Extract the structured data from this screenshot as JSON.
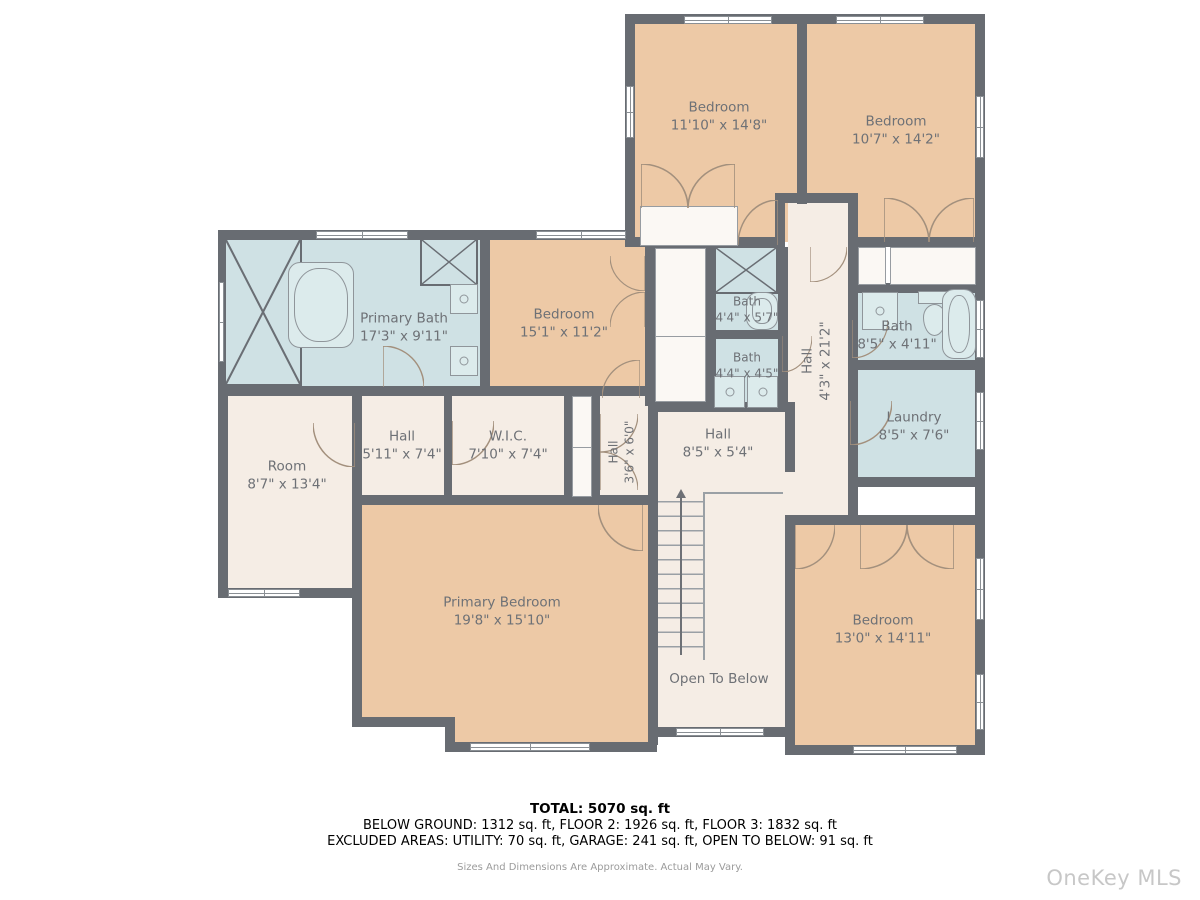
{
  "plan": {
    "rooms": {
      "bedroom_top_left": {
        "name": "Bedroom",
        "dims": "11'10\" x 14'8\""
      },
      "bedroom_top_right": {
        "name": "Bedroom",
        "dims": "10'7\" x 14'2\""
      },
      "primary_bath": {
        "name": "Primary Bath",
        "dims": "17'3\" x 9'11\""
      },
      "bedroom_middle": {
        "name": "Bedroom",
        "dims": "15'1\" x 11'2\""
      },
      "bath_upper": {
        "name": "Bath",
        "dims": "4'4\" x 5'7\""
      },
      "bath_lower": {
        "name": "Bath",
        "dims": "4'4\" x 4'5\""
      },
      "hall_vertical": {
        "name": "Hall",
        "dims": "4'3\" x 21'2\""
      },
      "bath_right": {
        "name": "Bath",
        "dims": "8'5\" x 4'11\""
      },
      "laundry": {
        "name": "Laundry",
        "dims": "8'5\" x 7'6\""
      },
      "room_left": {
        "name": "Room",
        "dims": "8'7\" x 13'4\""
      },
      "hall_small": {
        "name": "Hall",
        "dims": "5'11\" x 7'4\""
      },
      "wic": {
        "name": "W.I.C.",
        "dims": "7'10\" x 7'4\""
      },
      "hall_tiny": {
        "name": "Hall",
        "dims": "3'6\" x 6'0\""
      },
      "hall_center": {
        "name": "Hall",
        "dims": "8'5\" x 5'4\""
      },
      "primary_bedroom": {
        "name": "Primary Bedroom",
        "dims": "19'8\" x 15'10\""
      },
      "bedroom_bottom": {
        "name": "Bedroom",
        "dims": "13'0\" x 14'11\""
      },
      "open_to_below": {
        "name": "Open To Below"
      }
    },
    "colors": {
      "wall": "#686c72",
      "bedroom_fill": "#edc9a6",
      "bath_fill": "#cfe1e4",
      "hall_fill": "#f5ede5"
    }
  },
  "footer": {
    "total": "TOTAL: 5070 sq. ft",
    "areas": "BELOW GROUND: 1312 sq. ft, FLOOR 2: 1926 sq. ft, FLOOR 3: 1832 sq. ft",
    "excluded": "EXCLUDED AREAS: UTILITY: 70 sq. ft, GARAGE: 241 sq. ft, OPEN TO BELOW: 91 sq. ft",
    "disclaimer": "Sizes And Dimensions Are Approximate. Actual May Vary."
  },
  "watermark": "OneKey MLS"
}
